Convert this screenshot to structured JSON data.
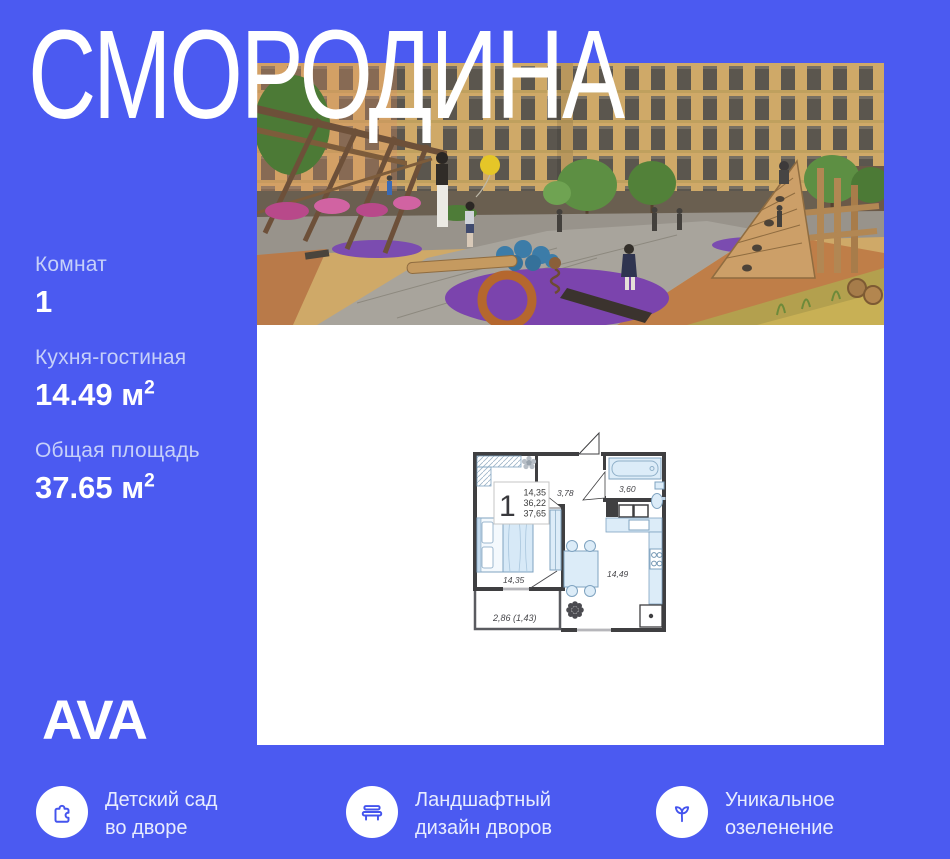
{
  "title": "СМОРОДИНА",
  "stats": [
    {
      "label": "Комнат",
      "value": "1",
      "sup": ""
    },
    {
      "label": "Кухня-гостиная",
      "value": "14.49 м",
      "sup": "2"
    },
    {
      "label": "Общая площадь",
      "value": "37.65 м",
      "sup": "2"
    }
  ],
  "logo": {
    "text": "AVA"
  },
  "features": [
    {
      "icon": "puzzle-icon",
      "line1": "Детский сад",
      "line2": "во дворе"
    },
    {
      "icon": "bench-icon",
      "line1": "Ландшафтный",
      "line2": "дизайн дворов"
    },
    {
      "icon": "sprout-icon",
      "line1": "Уникальное",
      "line2": "озеленение"
    }
  ],
  "floorplan": {
    "legend": {
      "rooms": "1",
      "area_living": "14,35",
      "area_no_balcony": "36,22",
      "area_total": "37,65"
    },
    "labels": {
      "hall": "3,78",
      "bathroom": "3,60",
      "bedroom": "14,35",
      "kitchen": "14,49",
      "balcony": "2,86 (1,43)"
    }
  },
  "colors": {
    "background": "#4b5af1",
    "panel": "#ffffff",
    "icon_accent": "#4454ee",
    "muted_label": "#c6d0f9",
    "plan_wall": "#3f3f41",
    "plan_furniture": "#dcecf8"
  }
}
